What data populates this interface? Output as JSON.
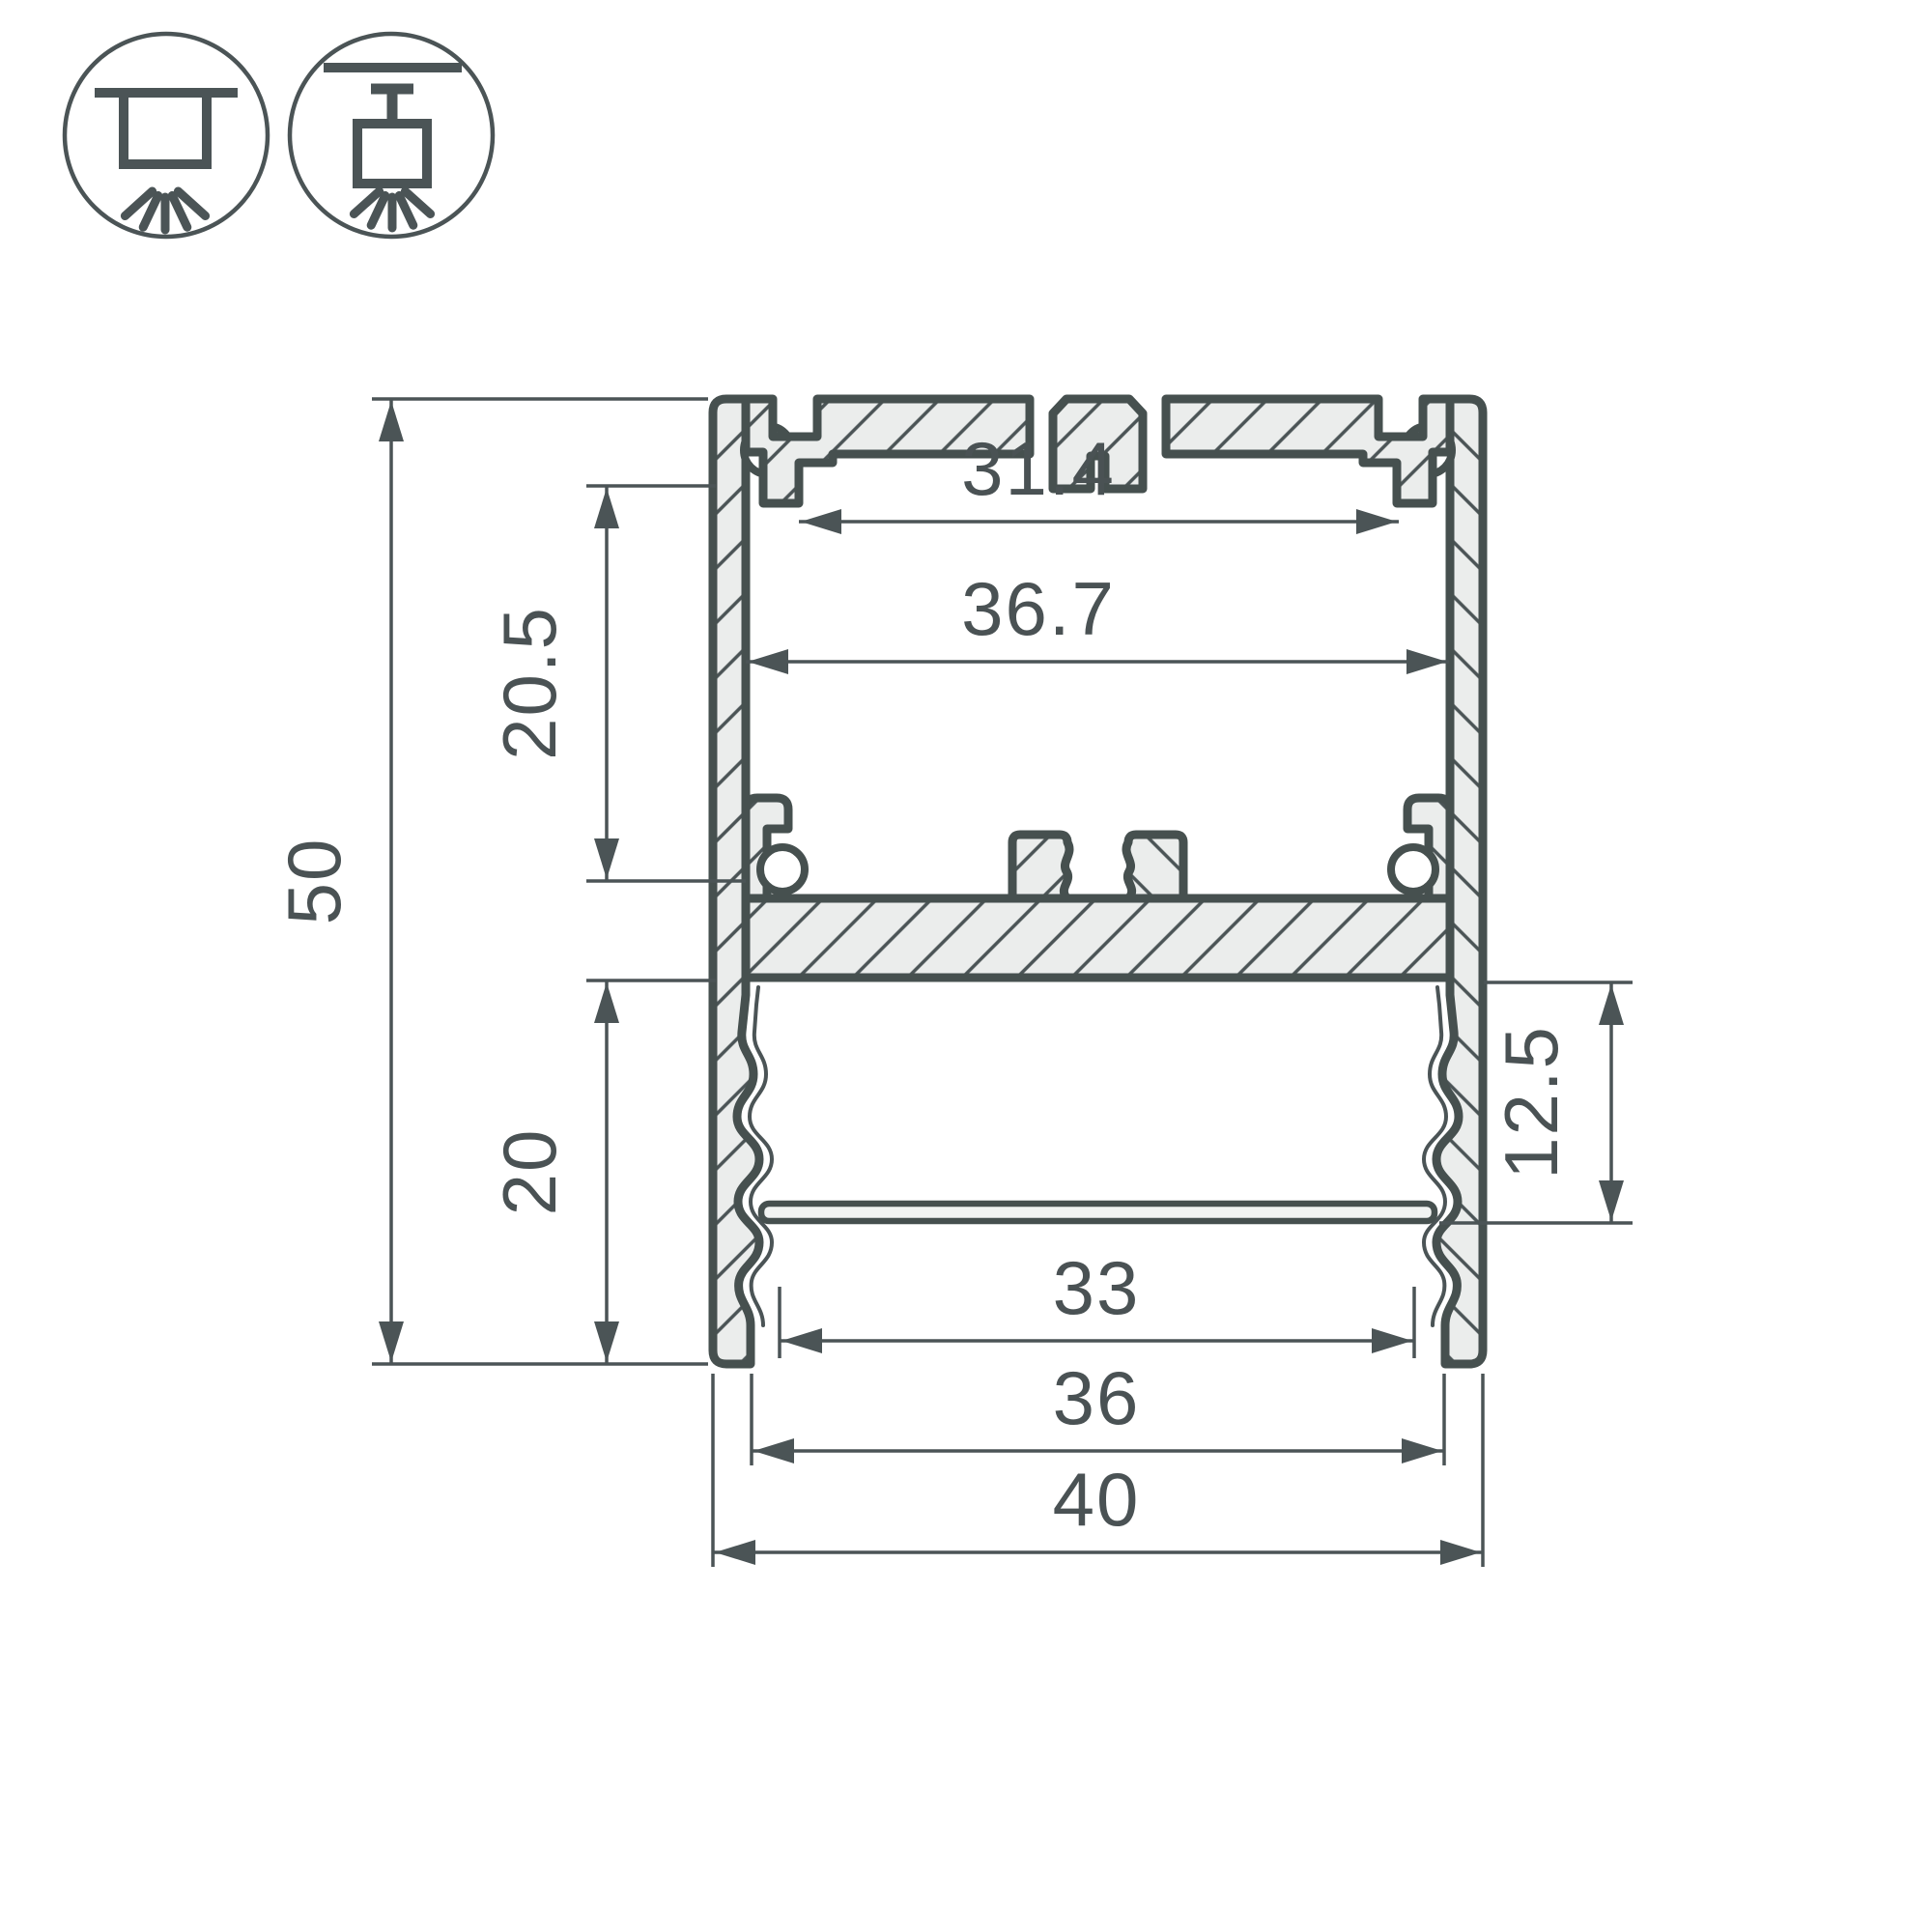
{
  "drawing": {
    "type": "led-profile-cross-section",
    "units": "mm"
  },
  "icons": {
    "surface_mount": "surface-ceiling-mount-icon",
    "pendant_mount": "suspended-pendant-mount-icon"
  },
  "dims": {
    "overall_height": "50",
    "overall_width": "40",
    "top_slot_width": "31.4",
    "upper_cavity_width": "36.7",
    "upper_cavity_height": "20.5",
    "lower_cavity_height": "20",
    "lens_recess_depth": "12.5",
    "lens_width": "33",
    "bottom_opening_width": "36"
  },
  "colors": {
    "line": "#4b5456",
    "outline": "#46504f",
    "aluminum_fill": "#ebedec",
    "background": "#ffffff"
  }
}
